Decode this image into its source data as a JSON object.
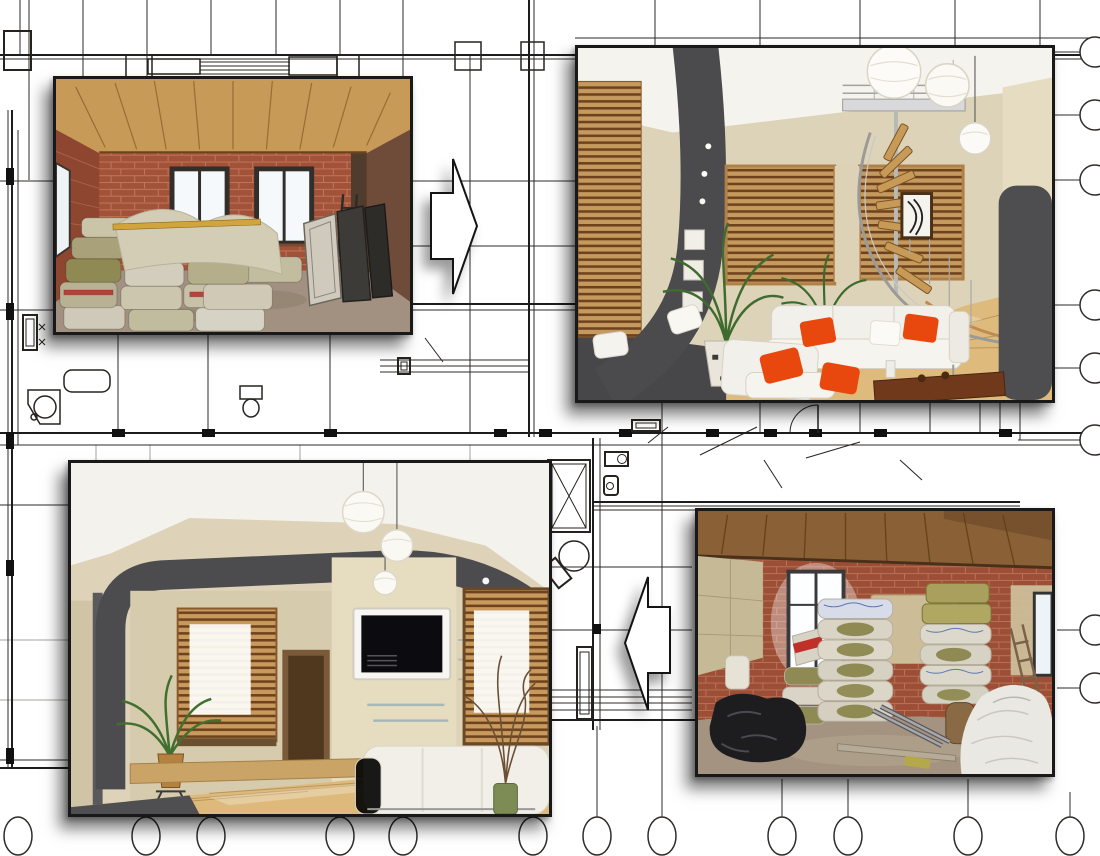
{
  "meta": {
    "description": "Apartment renovation before-and-after photo collage placed over an architectural floor-plan blueprint",
    "canvas": {
      "width": 1100,
      "height": 856
    },
    "visible_text": []
  },
  "colors": {
    "background": "#ffffff",
    "blueprint_line": "#2e2b28",
    "blueprint_line_light": "#a8a49e",
    "photo_border": "#191919",
    "shadow": "rgba(0,0,0,0.5)",
    "arrow_fill": "#ffffff",
    "arrow_outline": "#141414",
    "accent_orange": "#e8480e",
    "brick_red": "#a3523a",
    "timber_ceiling": "#c79a57",
    "insulation_olive": "#8f8a54",
    "wall_beige": "#ddd3b8",
    "panel_dark_gray": "#4b4b4e",
    "floor_wood": "#debb7d"
  },
  "photos": [
    {
      "id": "before-top-left",
      "stage": "before",
      "subject": "Unfinished room: bare red brick walls, timber plank ceiling, two bright windows, stacked mineral-wool insulation bags, leaning door panels and ladder",
      "x": 53,
      "y": 76,
      "width": 360,
      "height": 259
    },
    {
      "id": "after-top-right",
      "stage": "after",
      "subject": "Finished modern living room: white sofa with orange cushions, wooden blinds, plants, paper lantern lamps, spiral staircase and wood floor",
      "x": 575,
      "y": 45,
      "width": 480,
      "height": 358
    },
    {
      "id": "after-bottom-left",
      "stage": "after",
      "subject": "Finished modern living room: dark gray curved ceiling band, wall-mounted TV, wooden blinds, paper lanterns, white sofa and decorative branches",
      "x": 68,
      "y": 460,
      "width": 484,
      "height": 357
    },
    {
      "id": "before-bottom-right",
      "stage": "before",
      "subject": "Unfinished room: brick walls with plaster patches, plank ceiling, bright doorway, tall stacks of packed insulation, black and white plastic bundles",
      "x": 695,
      "y": 508,
      "width": 360,
      "height": 269
    }
  ],
  "arrows": [
    {
      "id": "before-to-after-top",
      "direction": "right",
      "meaning": "top-left before photo becomes top-right after photo",
      "x": 431,
      "y": 159,
      "width": 46,
      "height": 135
    },
    {
      "id": "before-to-after-bottom",
      "direction": "left",
      "meaning": "bottom-right before photo becomes bottom-left after photo",
      "x": 625,
      "y": 577,
      "width": 45,
      "height": 133
    }
  ],
  "blueprint": {
    "bubbles_bottom": {
      "cy": 836,
      "rx": 14,
      "ry": 19,
      "xs": [
        18,
        146,
        211,
        340,
        403,
        533,
        597,
        662,
        782,
        848,
        968,
        1070
      ]
    },
    "stems_bottom": [
      {
        "x": 597,
        "y1": 726
      },
      {
        "x": 782,
        "y1": 779
      },
      {
        "x": 848,
        "y1": 779
      },
      {
        "x": 968,
        "y1": 779
      },
      {
        "x": 1070,
        "y1": 792
      }
    ],
    "bubbles_right": {
      "cx": 1095,
      "r": 15,
      "ys": [
        52,
        115,
        180,
        305,
        368,
        440,
        630,
        688
      ]
    },
    "leaders_right": [
      {
        "y": 52,
        "x1": 1053
      },
      {
        "y": 115,
        "x1": 1053
      },
      {
        "y": 180,
        "x1": 1053
      },
      {
        "y": 305,
        "x1": 1053
      },
      {
        "y": 368,
        "x1": 1053
      },
      {
        "y": 440,
        "x1": 1018
      },
      {
        "y": 630,
        "x1": 1057
      },
      {
        "y": 688,
        "x1": 1057
      }
    ]
  }
}
